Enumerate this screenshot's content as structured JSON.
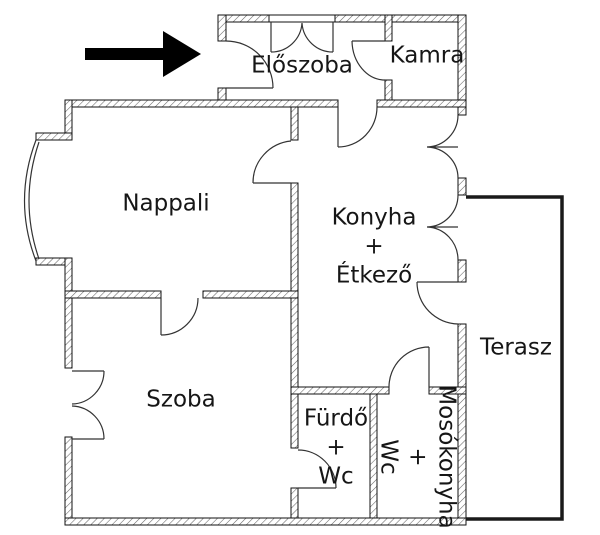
{
  "floorplan": {
    "colors": {
      "background": "#ffffff",
      "walls": "#111111",
      "hatch": "#666666",
      "door_lines": "#333333",
      "terrace_outline": "#1a1a1a",
      "text": "#161616",
      "arrow": "#000000"
    },
    "entrance_arrow": {
      "icon": "arrow-right-icon",
      "direction": "right"
    },
    "rooms": {
      "eloszoba": {
        "label": "Előszoba"
      },
      "kamra": {
        "label": "Kamra"
      },
      "nappali": {
        "label": "Nappali"
      },
      "konyha_etkezo": {
        "line1": "Konyha",
        "line2": "+",
        "line3": "Étkező"
      },
      "szoba": {
        "label": "Szoba"
      },
      "terasz": {
        "label": "Terasz"
      },
      "furdo_wc": {
        "line1": "Fürdő",
        "line2": "+",
        "line3": "Wc"
      },
      "mosokonyha_wc": {
        "line1": "Mosókonyha",
        "line2": "+",
        "line3": "Wc"
      }
    }
  }
}
